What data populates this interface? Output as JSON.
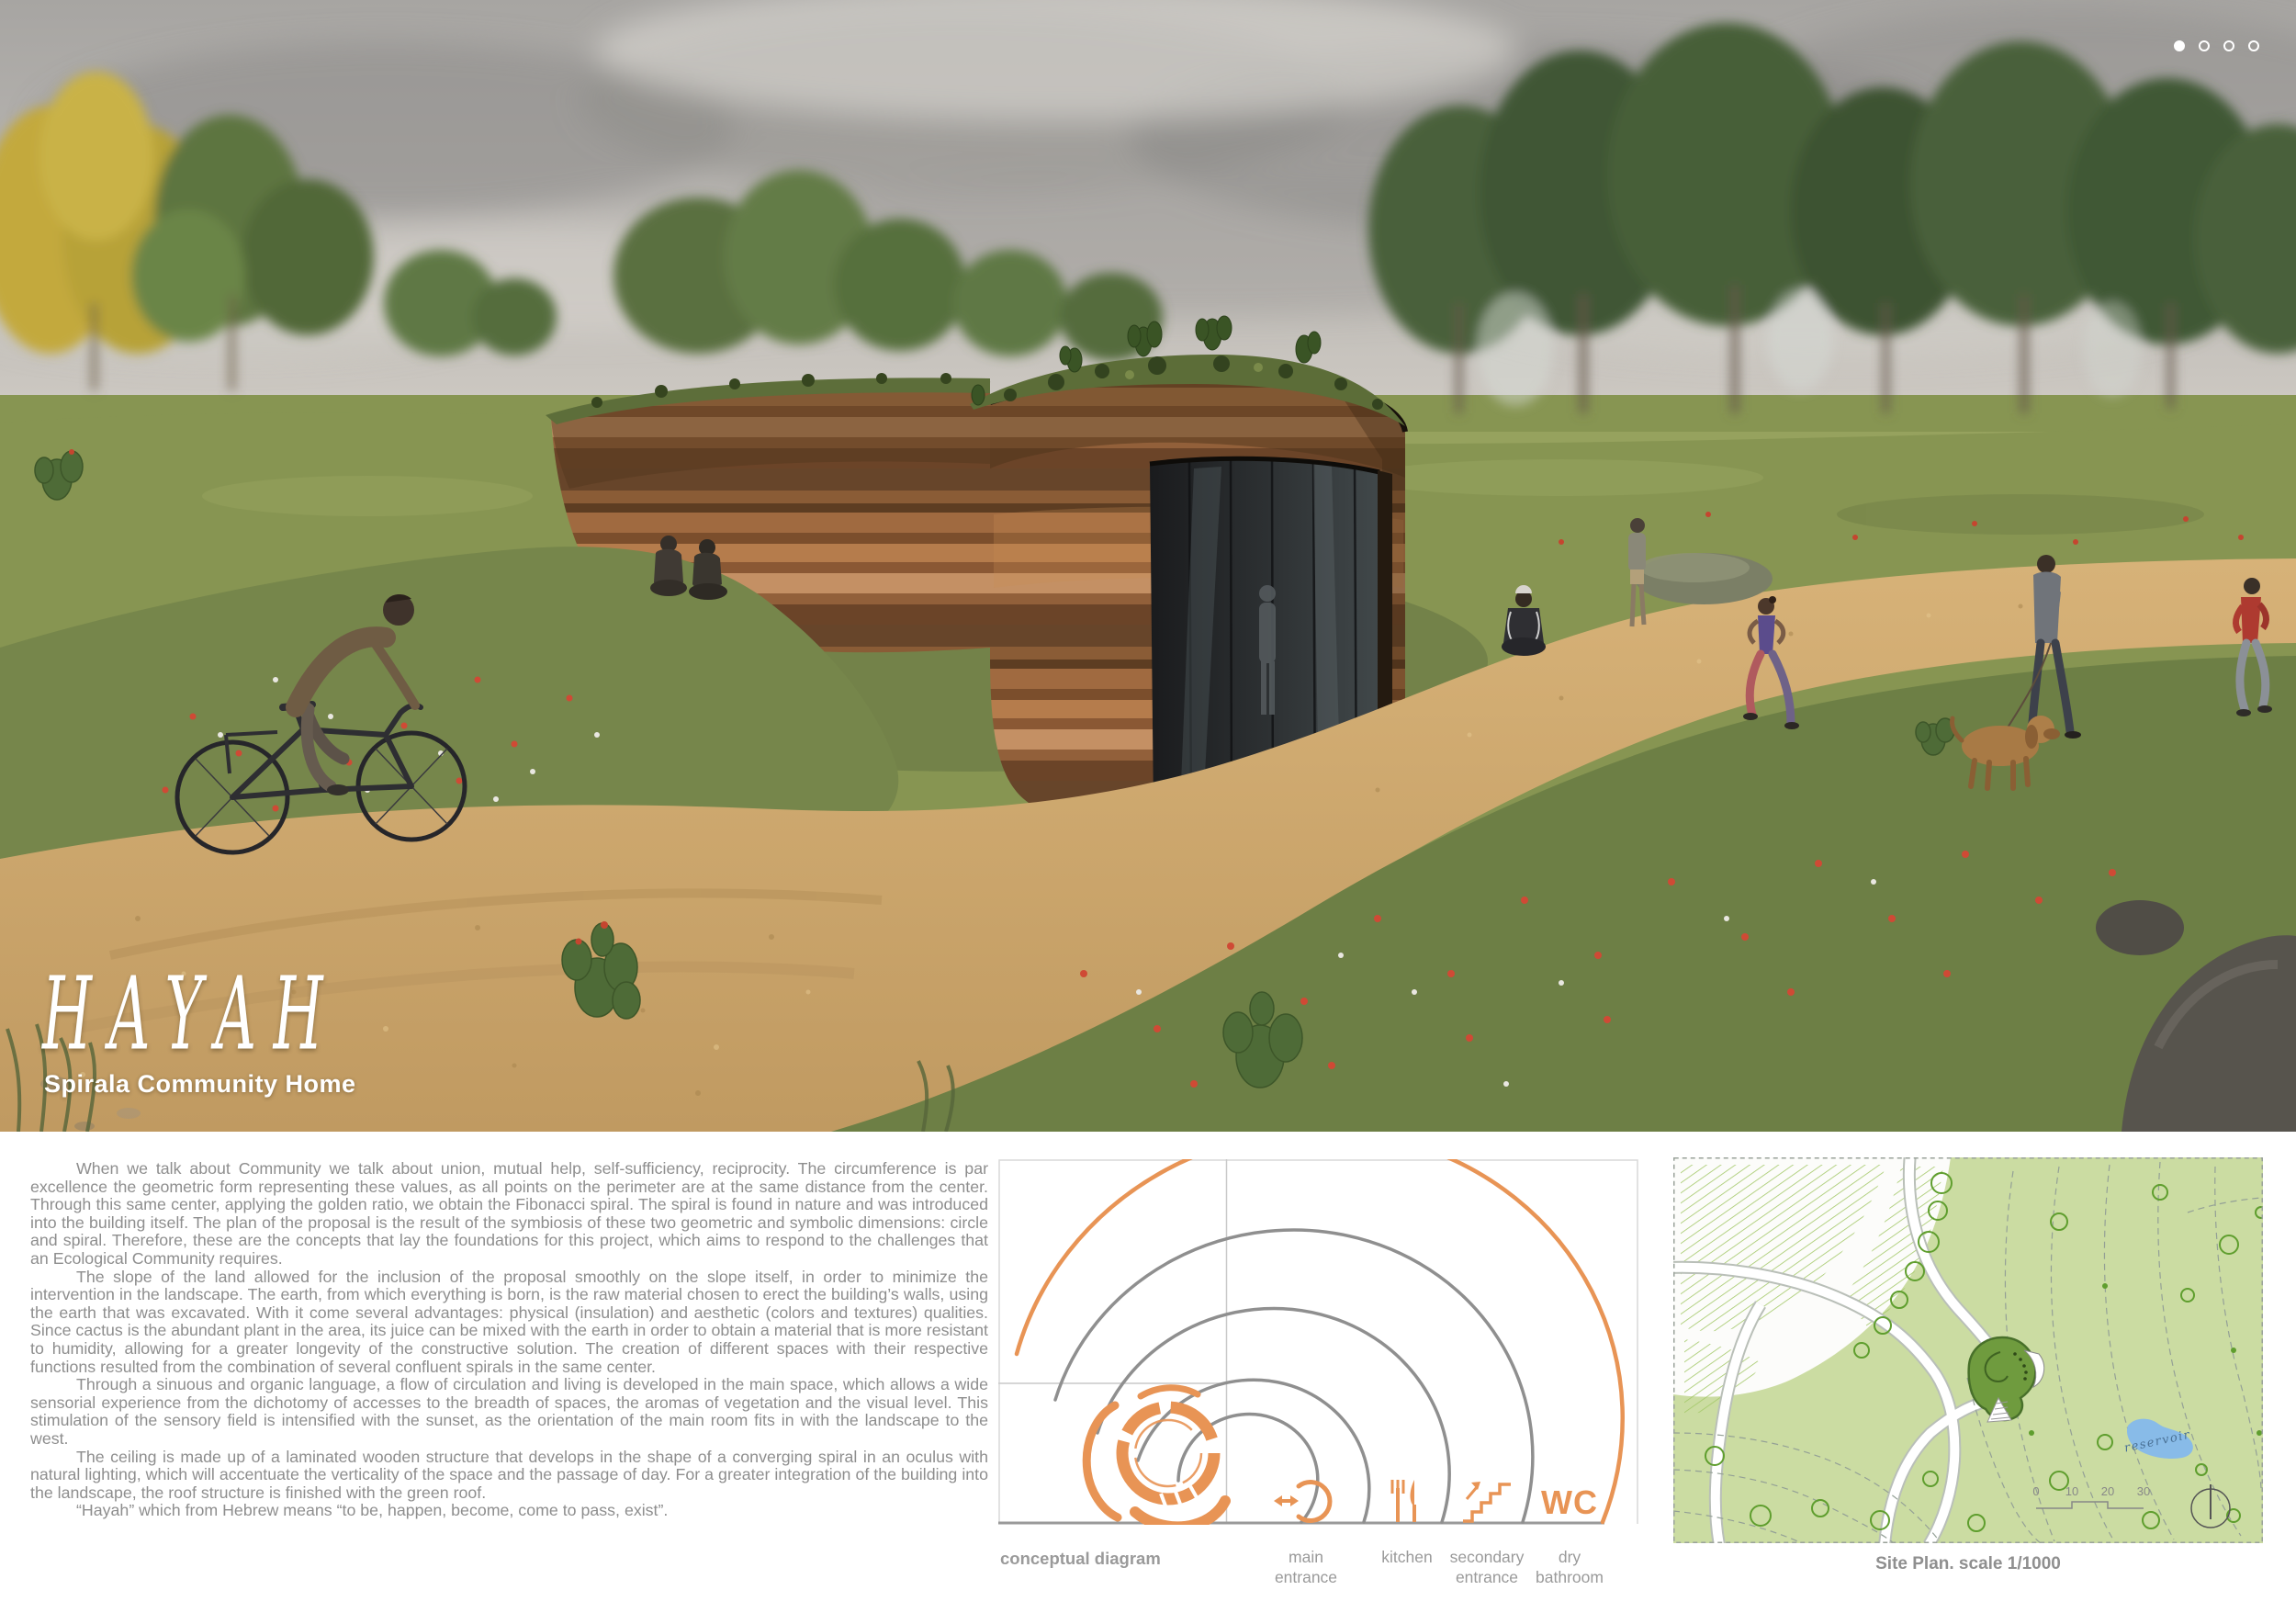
{
  "carousel": {
    "dot_count": 4,
    "active_dot": 1
  },
  "hero": {
    "title": "HAYAH",
    "subtitle": "Spirala Community Home"
  },
  "article": {
    "paragraphs": [
      "When we talk about Community we talk about union, mutual help, self-sufficiency, reciprocity. The circumference is par excellence the geometric form representing these values, as all points on the perimeter are at the same distance from the center. Through this same center, applying the golden ratio, we obtain the Fibonacci spiral. The spiral is found in nature and was introduced into the building itself. The plan of the proposal is the result of the symbiosis of these two geometric and symbolic dimensions: circle and spiral. Therefore, these are the concepts that lay the foundations for this project, which aims to respond to the challenges that an Ecological Community requires.",
      "The slope of the land allowed for the inclusion of the proposal smoothly on the slope itself, in order to minimize the intervention in the landscape. The earth, from which everything is born, is the raw material chosen to erect the building’s walls, using the earth that was excavated. With it come several advantages: physical (insulation) and aesthetic (colors and textures) qualities. Since cactus is the abundant plant in the area, its juice can be mixed with the earth in order to obtain a material that is more resistant to humidity, allowing for a greater longevity of the constructive solution. The creation of different spaces with their respective functions resulted from the combination of several confluent spirals in the same center.",
      "Through a sinuous and organic language, a flow of circulation and living is developed in the main space, which allows a wide sensorial experience from the dichotomy of accesses to the breadth of spaces, the aromas of vegetation and the visual level. This stimulation of the sensory field is intensified with the sunset, as the orientation of the main room fits in with the landscape to the west.",
      "The ceiling is made up of a laminated wooden structure that develops in the shape of a converging spiral in an oculus with natural lighting, which will accentuate the verticality of the space and the passage of day. For a greater integration of the building into the landscape, the roof structure is finished with the green roof.",
      "“Hayah” which from Hebrew means “to be, happen, become, come to pass, exist”."
    ]
  },
  "diagram": {
    "caption": "conceptual diagram",
    "wc_label": "WC",
    "legend": [
      {
        "top": "main",
        "bottom": "entrance"
      },
      {
        "top": "kitchen",
        "bottom": ""
      },
      {
        "top": "secondary",
        "bottom": "entrance"
      },
      {
        "top": "dry",
        "bottom": "bathroom"
      }
    ]
  },
  "siteplan": {
    "caption": "Site Plan. scale 1/1000",
    "reservoir_label": "reservoir",
    "scale_ticks": [
      "0",
      "10",
      "20",
      "30"
    ]
  },
  "colors": {
    "accent_orange": "#e89455",
    "diagram_gray": "#8f8f8f",
    "text_gray": "#8e8e8e",
    "plan_green": "#cbdca2",
    "reservoir_blue": "#88bbe8"
  }
}
